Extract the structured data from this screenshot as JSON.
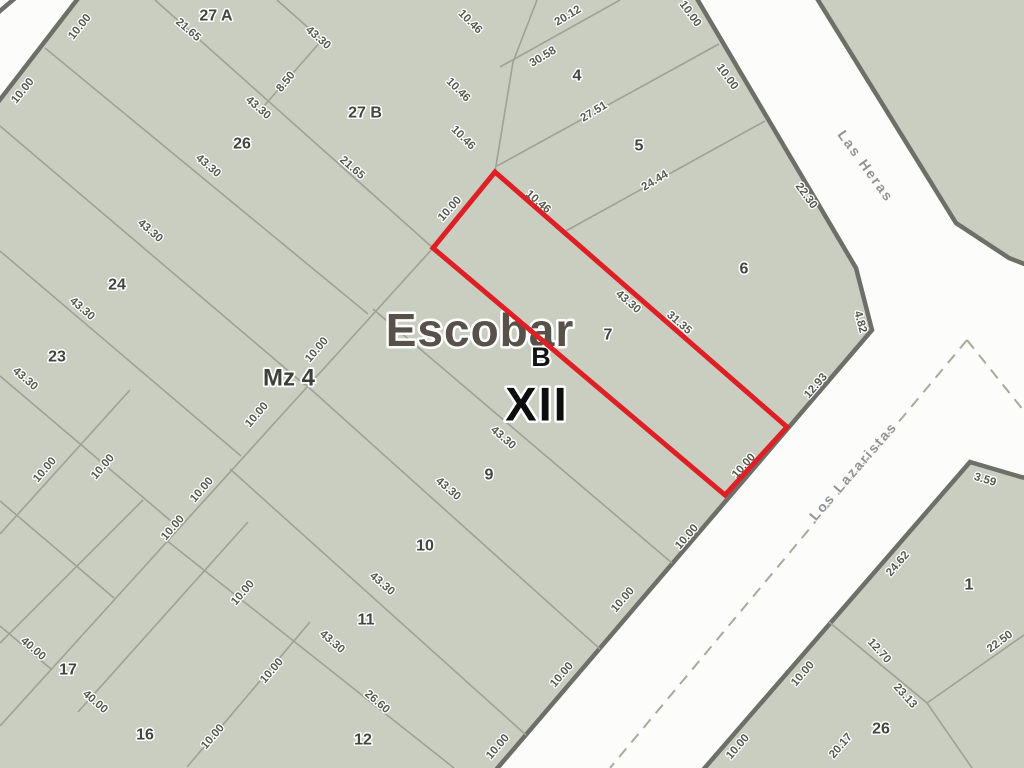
{
  "map": {
    "area_title": "Escobar",
    "zone_letter": "B",
    "zone_roman": "XII",
    "block_label": "Mz 4",
    "colors": {
      "highlight": "#de2026",
      "block_fill": "#c9cec0",
      "block_border": "#6e6f68",
      "street_bg": "#fcfcfa"
    },
    "streets": [
      {
        "name": "Las Heras",
        "x": 866,
        "y": 166,
        "rot": 54
      },
      {
        "name": "Los Lazaristas",
        "x": 853,
        "y": 471,
        "rot": -49
      }
    ],
    "parcel_numbers": [
      {
        "label": "27 A",
        "x": 216,
        "y": 16
      },
      {
        "label": "27 B",
        "x": 365,
        "y": 113
      },
      {
        "label": "26",
        "x": 242,
        "y": 144
      },
      {
        "label": "24",
        "x": 117,
        "y": 285
      },
      {
        "label": "23",
        "x": 57,
        "y": 357
      },
      {
        "label": "17",
        "x": 68,
        "y": 670
      },
      {
        "label": "16",
        "x": 145,
        "y": 735
      },
      {
        "label": "4",
        "x": 577,
        "y": 76
      },
      {
        "label": "5",
        "x": 639,
        "y": 146
      },
      {
        "label": "6",
        "x": 744,
        "y": 269
      },
      {
        "label": "7",
        "x": 608,
        "y": 335
      },
      {
        "label": "9",
        "x": 489,
        "y": 475
      },
      {
        "label": "10",
        "x": 425,
        "y": 546
      },
      {
        "label": "11",
        "x": 366,
        "y": 620
      },
      {
        "label": "12",
        "x": 363,
        "y": 740
      },
      {
        "label": "1",
        "x": 969,
        "y": 585
      },
      {
        "label": "26",
        "x": 881,
        "y": 729
      }
    ],
    "dimension_labels": [
      {
        "t": "10.00",
        "x": 80,
        "y": 27,
        "r": -51
      },
      {
        "t": "10.00",
        "x": 23,
        "y": 91,
        "r": -51
      },
      {
        "t": "21.65",
        "x": 188,
        "y": 30,
        "r": 41
      },
      {
        "t": "43.30",
        "x": 318,
        "y": 38,
        "r": 41
      },
      {
        "t": "8.50",
        "x": 286,
        "y": 82,
        "r": -51
      },
      {
        "t": "43.30",
        "x": 258,
        "y": 108,
        "r": 41
      },
      {
        "t": "43.30",
        "x": 208,
        "y": 166,
        "r": 41
      },
      {
        "t": "43.30",
        "x": 150,
        "y": 231,
        "r": 41
      },
      {
        "t": "43.30",
        "x": 82,
        "y": 309,
        "r": 41
      },
      {
        "t": "43.30",
        "x": 25,
        "y": 379,
        "r": 41
      },
      {
        "t": "21.65",
        "x": 352,
        "y": 168,
        "r": 41
      },
      {
        "t": "10.46",
        "x": 470,
        "y": 22,
        "r": 45
      },
      {
        "t": "10.46",
        "x": 458,
        "y": 90,
        "r": 45
      },
      {
        "t": "10.46",
        "x": 463,
        "y": 138,
        "r": 45
      },
      {
        "t": "20.12",
        "x": 568,
        "y": 16,
        "r": -31
      },
      {
        "t": "30.58",
        "x": 543,
        "y": 57,
        "r": -31
      },
      {
        "t": "27.51",
        "x": 594,
        "y": 112,
        "r": -31
      },
      {
        "t": "24.44",
        "x": 655,
        "y": 181,
        "r": -31
      },
      {
        "t": "10.00",
        "x": 690,
        "y": 14,
        "r": 54
      },
      {
        "t": "10.00",
        "x": 727,
        "y": 77,
        "r": 54
      },
      {
        "t": "22.30",
        "x": 806,
        "y": 196,
        "r": 54
      },
      {
        "t": "10.00",
        "x": 450,
        "y": 209,
        "r": -48
      },
      {
        "t": "10.46",
        "x": 538,
        "y": 202,
        "r": 41
      },
      {
        "t": "43.30",
        "x": 628,
        "y": 302,
        "r": 41
      },
      {
        "t": "31.35",
        "x": 679,
        "y": 323,
        "r": 41
      },
      {
        "t": "4.82",
        "x": 860,
        "y": 322,
        "r": 75
      },
      {
        "t": "12.93",
        "x": 816,
        "y": 386,
        "r": -49
      },
      {
        "t": "10.00",
        "x": 744,
        "y": 466,
        "r": -48
      },
      {
        "t": "43.30",
        "x": 503,
        "y": 438,
        "r": 41
      },
      {
        "t": "43.30",
        "x": 448,
        "y": 489,
        "r": 41
      },
      {
        "t": "43.30",
        "x": 382,
        "y": 584,
        "r": 41
      },
      {
        "t": "43.30",
        "x": 332,
        "y": 642,
        "r": 41
      },
      {
        "t": "26.60",
        "x": 377,
        "y": 702,
        "r": 41
      },
      {
        "t": "10.00",
        "x": 687,
        "y": 537,
        "r": -49
      },
      {
        "t": "10.00",
        "x": 623,
        "y": 600,
        "r": -49
      },
      {
        "t": "10.00",
        "x": 562,
        "y": 675,
        "r": -49
      },
      {
        "t": "10.00",
        "x": 498,
        "y": 747,
        "r": -49
      },
      {
        "t": "10.00",
        "x": 317,
        "y": 350,
        "r": -49
      },
      {
        "t": "10.00",
        "x": 257,
        "y": 415,
        "r": -49
      },
      {
        "t": "10.00",
        "x": 202,
        "y": 490,
        "r": -49
      },
      {
        "t": "10.00",
        "x": 173,
        "y": 528,
        "r": -49
      },
      {
        "t": "10.00",
        "x": 243,
        "y": 593,
        "r": -49
      },
      {
        "t": "10.00",
        "x": 103,
        "y": 467,
        "r": -49
      },
      {
        "t": "10.00",
        "x": 45,
        "y": 470,
        "r": -49
      },
      {
        "t": "10.00",
        "x": 272,
        "y": 671,
        "r": -49
      },
      {
        "t": "10.00",
        "x": 213,
        "y": 737,
        "r": -49
      },
      {
        "t": "40.00",
        "x": 33,
        "y": 649,
        "r": 41
      },
      {
        "t": "40.00",
        "x": 95,
        "y": 702,
        "r": 41
      },
      {
        "t": "3.59",
        "x": 985,
        "y": 480,
        "r": 17
      },
      {
        "t": "24.62",
        "x": 898,
        "y": 564,
        "r": -49
      },
      {
        "t": "12.70",
        "x": 879,
        "y": 651,
        "r": 48
      },
      {
        "t": "23.13",
        "x": 905,
        "y": 696,
        "r": 48
      },
      {
        "t": "22.50",
        "x": 1000,
        "y": 642,
        "r": -37
      },
      {
        "t": "20.17",
        "x": 841,
        "y": 746,
        "r": -49
      },
      {
        "t": "10.00",
        "x": 803,
        "y": 674,
        "r": -49
      },
      {
        "t": "10.00",
        "x": 738,
        "y": 747,
        "r": -49
      }
    ]
  }
}
